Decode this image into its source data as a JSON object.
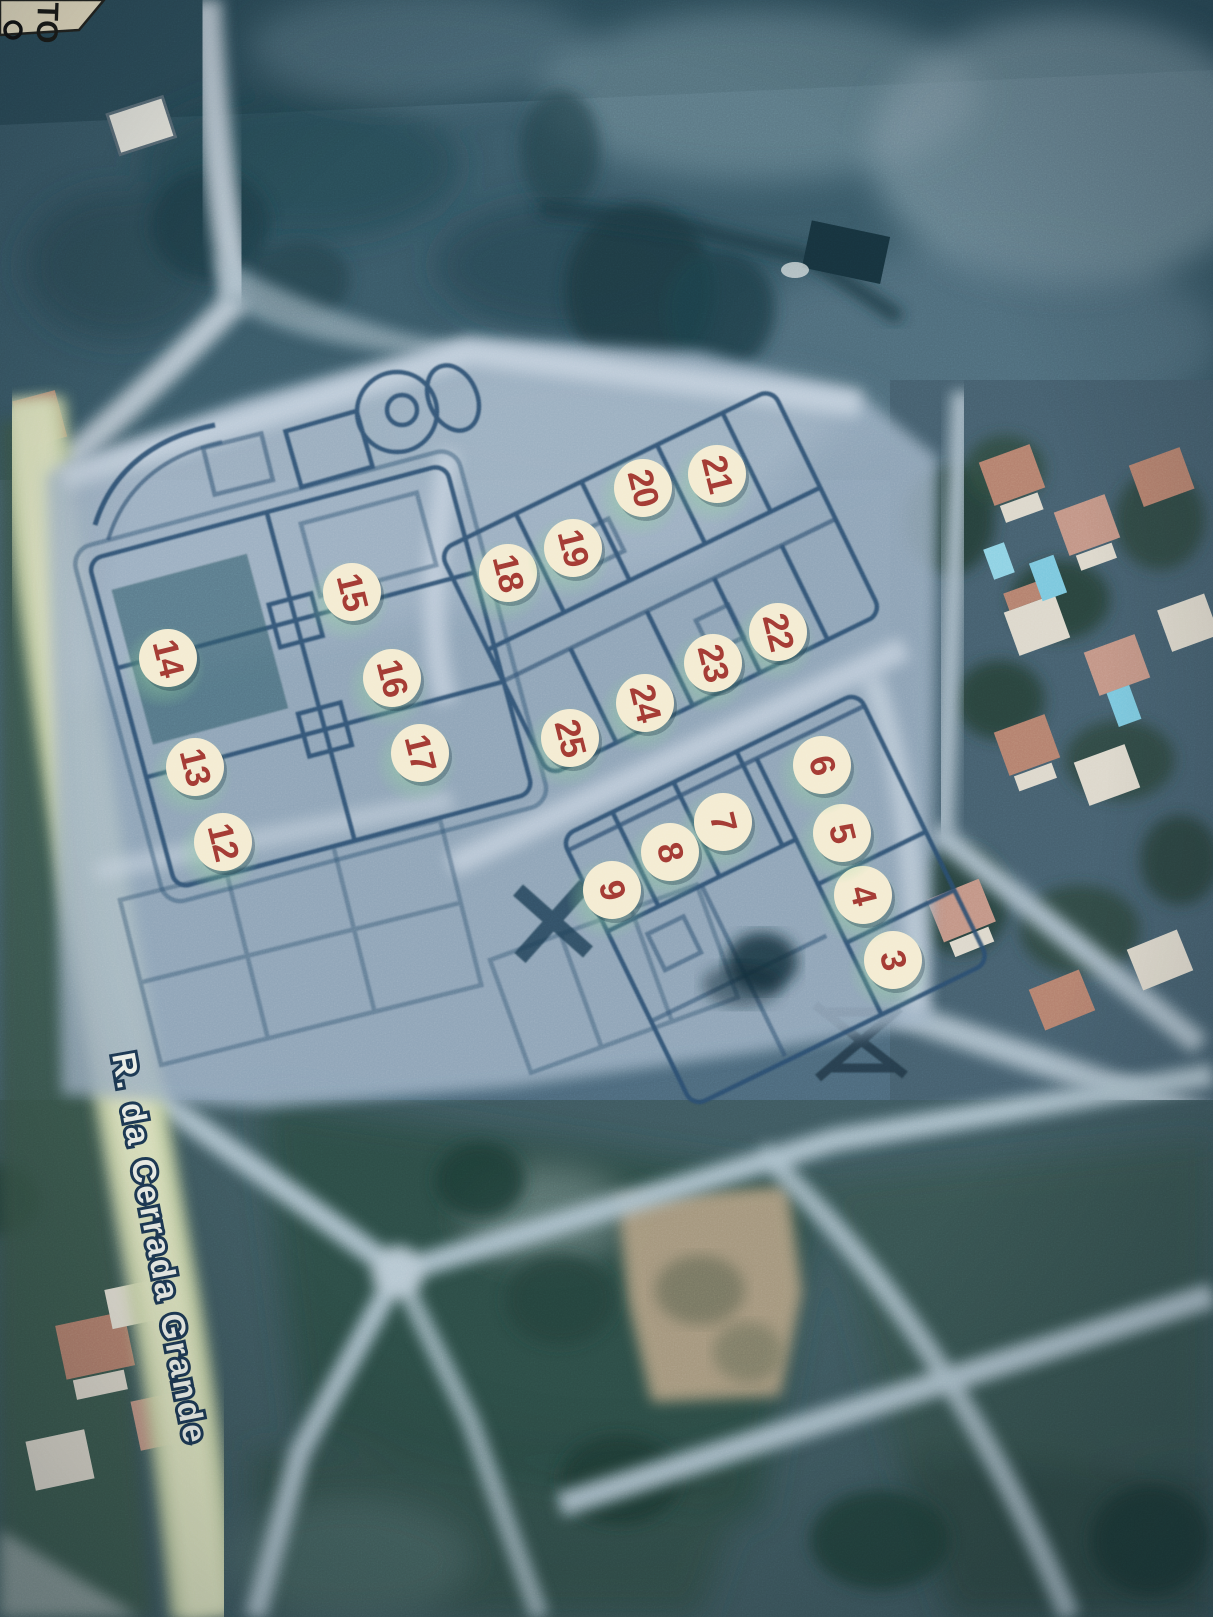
{
  "scene": {
    "description": "photograph of a printed aerial map with subdivision lot plan overlay",
    "corner_note": {
      "text": "TO"
    },
    "street": {
      "name": "R. da Cerrada Grande"
    }
  },
  "markers": {
    "fill": "#f4ecd2",
    "number_color": "#a23a33",
    "halo_color": "#8fd49b",
    "number_rotation_deg": 76,
    "items": [
      {
        "n": "3",
        "x": 893,
        "y": 960
      },
      {
        "n": "4",
        "x": 863,
        "y": 895
      },
      {
        "n": "5",
        "x": 842,
        "y": 833
      },
      {
        "n": "6",
        "x": 822,
        "y": 765
      },
      {
        "n": "7",
        "x": 723,
        "y": 822
      },
      {
        "n": "8",
        "x": 670,
        "y": 852
      },
      {
        "n": "9",
        "x": 612,
        "y": 890
      },
      {
        "n": "12",
        "x": 223,
        "y": 842
      },
      {
        "n": "13",
        "x": 195,
        "y": 767
      },
      {
        "n": "14",
        "x": 168,
        "y": 658
      },
      {
        "n": "15",
        "x": 352,
        "y": 592
      },
      {
        "n": "16",
        "x": 392,
        "y": 678
      },
      {
        "n": "17",
        "x": 420,
        "y": 753
      },
      {
        "n": "18",
        "x": 508,
        "y": 573
      },
      {
        "n": "19",
        "x": 573,
        "y": 548
      },
      {
        "n": "20",
        "x": 643,
        "y": 488
      },
      {
        "n": "21",
        "x": 717,
        "y": 474
      },
      {
        "n": "22",
        "x": 778,
        "y": 632
      },
      {
        "n": "23",
        "x": 713,
        "y": 663
      },
      {
        "n": "24",
        "x": 645,
        "y": 703
      },
      {
        "n": "25",
        "x": 570,
        "y": 738
      }
    ]
  },
  "colors": {
    "plan_fill": "#9fb3c6",
    "plan_line": "#2c4e70",
    "plan_road": "#c6d2de",
    "satellite_road": "#aabfca",
    "yellow_road": "#e2e7c3",
    "roof": "#b98a77",
    "tree": "#223f3b",
    "pool": "#7cc8de",
    "label_fill": "#f2f5ee",
    "label_outline": "#1d3954"
  }
}
